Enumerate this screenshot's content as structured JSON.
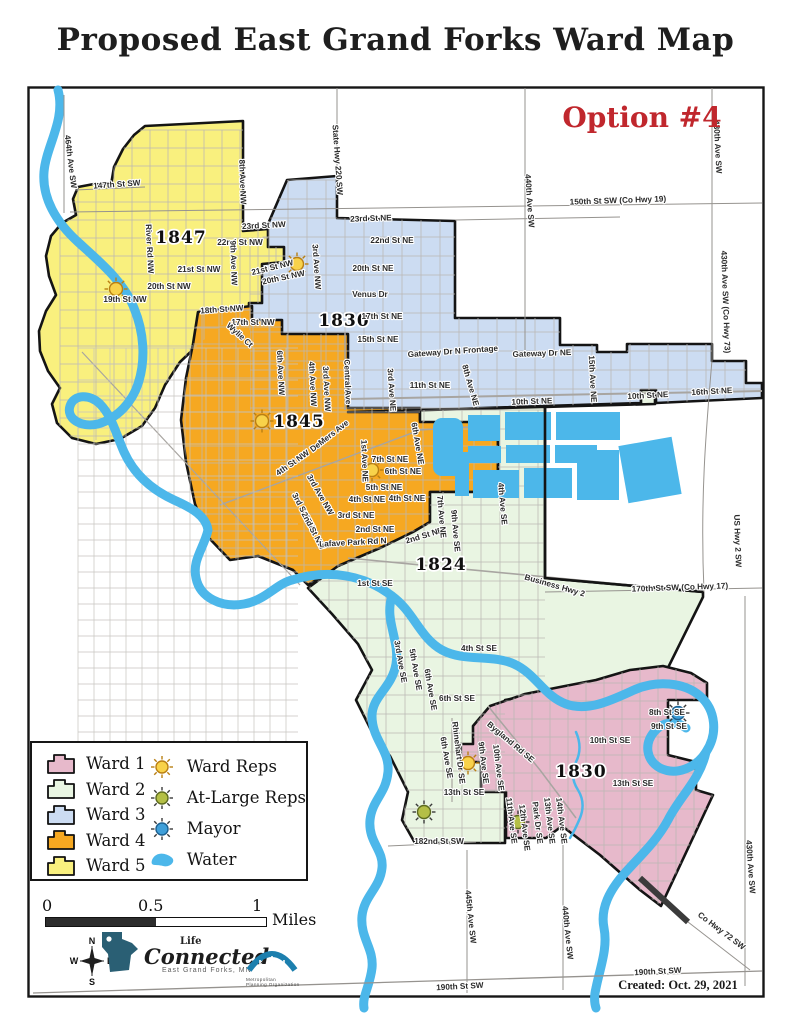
{
  "title": "Proposed East Grand Forks Ward Map",
  "option_label": "Option #4",
  "created_label": "Created: Oct. 29, 2021",
  "colors": {
    "ward1": "#e7b9cb",
    "ward2": "#e9f5e2",
    "ward3": "#ccdcf2",
    "ward4": "#f6a821",
    "ward5": "#f9f07e",
    "water": "#4cb7ea",
    "red": "#c0272d",
    "boundary": "#141414",
    "rep_ward_fill": "#f8d24a",
    "rep_ward_ray": "#b97f13",
    "rep_atlarge_fill": "#b4bf46",
    "rep_mayor_fill": "#3f9fd9",
    "rep_dark_ray": "#3a3a3a",
    "logo_teal": "#2a5f74",
    "logo_arch": "#1c7fae"
  },
  "legend": {
    "wards": [
      {
        "label": "Ward 1",
        "color_key": "ward1"
      },
      {
        "label": "Ward 2",
        "color_key": "ward2"
      },
      {
        "label": "Ward 3",
        "color_key": "ward3"
      },
      {
        "label": "Ward 4",
        "color_key": "ward4"
      },
      {
        "label": "Ward 5",
        "color_key": "ward5"
      }
    ],
    "symbols": [
      {
        "label": "Ward Reps",
        "kind": "ward"
      },
      {
        "label": "At-Large Reps",
        "kind": "atlarge"
      },
      {
        "label": "Mayor",
        "kind": "mayor"
      },
      {
        "label": "Water",
        "kind": "water"
      }
    ]
  },
  "scale_bar": {
    "start": "0",
    "mid": "0.5",
    "end": "1",
    "unit": "Miles"
  },
  "compass": {
    "n": "N",
    "e": "E",
    "s": "S",
    "w": "W"
  },
  "logos": {
    "life_connected": {
      "line1": "Life",
      "line2": "Connected",
      "line3": "East Grand Forks, MN"
    },
    "mpo": {
      "line1": "Metropolitan",
      "line2": "Planning Organization"
    }
  },
  "map": {
    "ward_numbers": [
      {
        "text": "1847",
        "x": 181,
        "y": 243
      },
      {
        "text": "1830",
        "x": 344,
        "y": 326
      },
      {
        "text": "1845",
        "x": 299,
        "y": 427
      },
      {
        "text": "1824",
        "x": 441,
        "y": 570
      },
      {
        "text": "1830",
        "x": 581,
        "y": 777
      }
    ],
    "reps": [
      {
        "kind": "ward",
        "x": 116,
        "y": 289
      },
      {
        "kind": "ward",
        "x": 297,
        "y": 264
      },
      {
        "kind": "ward",
        "x": 262,
        "y": 421
      },
      {
        "kind": "ward",
        "x": 372,
        "y": 470
      },
      {
        "kind": "ward",
        "x": 468,
        "y": 763
      },
      {
        "kind": "atlarge",
        "x": 424,
        "y": 812
      },
      {
        "kind": "atlarge",
        "x": 518,
        "y": 822
      },
      {
        "kind": "mayor",
        "x": 678,
        "y": 713
      }
    ],
    "street_labels": [
      {
        "t": "464th Ave SW",
        "x": 68,
        "y": 162,
        "r": 83
      },
      {
        "t": "147th St SW",
        "x": 117,
        "y": 187,
        "r": -4
      },
      {
        "t": "River Rd NW",
        "x": 147,
        "y": 249,
        "r": 87
      },
      {
        "t": "8th Ave NW",
        "x": 240,
        "y": 182,
        "r": 88
      },
      {
        "t": "23rd St NW",
        "x": 264,
        "y": 228,
        "r": -3
      },
      {
        "t": "22nd St NW",
        "x": 240,
        "y": 245,
        "r": 0
      },
      {
        "t": "21st St NW",
        "x": 199,
        "y": 272,
        "r": 0
      },
      {
        "t": "20th St NW",
        "x": 169,
        "y": 289,
        "r": 0
      },
      {
        "t": "19th St NW",
        "x": 125,
        "y": 302,
        "r": 0
      },
      {
        "t": "18th St NW",
        "x": 222,
        "y": 312,
        "r": -4
      },
      {
        "t": "17th St NW",
        "x": 253,
        "y": 325,
        "r": 0
      },
      {
        "t": "9th Ave NW",
        "x": 231,
        "y": 263,
        "r": 88
      },
      {
        "t": "21st St NW",
        "x": 273,
        "y": 270,
        "r": -14
      },
      {
        "t": "20th St NW",
        "x": 284,
        "y": 280,
        "r": -12
      },
      {
        "t": "State Hwy 220 SW",
        "x": 335,
        "y": 160,
        "r": 86
      },
      {
        "t": "23rd St NE",
        "x": 371,
        "y": 221,
        "r": -2
      },
      {
        "t": "22nd St NE",
        "x": 392,
        "y": 243,
        "r": 0
      },
      {
        "t": "3rd Ave NW",
        "x": 314,
        "y": 267,
        "r": 86
      },
      {
        "t": "20th St NE",
        "x": 373,
        "y": 271,
        "r": 0
      },
      {
        "t": "Venus Dr",
        "x": 370,
        "y": 297,
        "r": 0
      },
      {
        "t": "17th St NE",
        "x": 382,
        "y": 319,
        "r": 0
      },
      {
        "t": "15th St NE",
        "x": 378,
        "y": 342,
        "r": 0
      },
      {
        "t": "Gateway Dr N Frontage",
        "x": 453,
        "y": 354,
        "r": -4
      },
      {
        "t": "Gateway Dr NE",
        "x": 542,
        "y": 356,
        "r": -2
      },
      {
        "t": "3rd Ave NE",
        "x": 389,
        "y": 390,
        "r": 86
      },
      {
        "t": "11th St NE",
        "x": 430,
        "y": 388,
        "r": 0
      },
      {
        "t": "8th Ave NE",
        "x": 468,
        "y": 386,
        "r": 74
      },
      {
        "t": "15th Ave NE",
        "x": 590,
        "y": 379,
        "r": 87
      },
      {
        "t": "10th St NE",
        "x": 532,
        "y": 404,
        "r": -2
      },
      {
        "t": "10th St NE",
        "x": 648,
        "y": 398,
        "r": -3
      },
      {
        "t": "16th St NE",
        "x": 712,
        "y": 394,
        "r": -3
      },
      {
        "t": "150th St SW (Co Hwy 19)",
        "x": 618,
        "y": 203,
        "r": -2
      },
      {
        "t": "440th Ave SW",
        "x": 527,
        "y": 201,
        "r": 86
      },
      {
        "t": "430th Ave SW",
        "x": 715,
        "y": 147,
        "r": 87
      },
      {
        "t": "430th Ave SW (Co Hwy 73)",
        "x": 723,
        "y": 302,
        "r": 88
      },
      {
        "t": "Wylie Ct",
        "x": 238,
        "y": 337,
        "r": 42
      },
      {
        "t": "6th Ave NW",
        "x": 278,
        "y": 373,
        "r": 87
      },
      {
        "t": "4th Ave NW",
        "x": 310,
        "y": 384,
        "r": 87
      },
      {
        "t": "3rd Ave NW",
        "x": 324,
        "y": 389,
        "r": 87
      },
      {
        "t": "Central Ave",
        "x": 345,
        "y": 382,
        "r": 88
      },
      {
        "t": "DeMers Ave",
        "x": 331,
        "y": 438,
        "r": -38
      },
      {
        "t": "4th St NW",
        "x": 294,
        "y": 465,
        "r": -35
      },
      {
        "t": "1st Ave NE",
        "x": 362,
        "y": 461,
        "r": 88
      },
      {
        "t": "7th St NE",
        "x": 390,
        "y": 462,
        "r": 0
      },
      {
        "t": "6th St NE",
        "x": 403,
        "y": 474,
        "r": 0
      },
      {
        "t": "5th St NE",
        "x": 384,
        "y": 490,
        "r": 0
      },
      {
        "t": "4th St NE",
        "x": 367,
        "y": 502,
        "r": 0
      },
      {
        "t": "4th St NE",
        "x": 407,
        "y": 501,
        "r": 0
      },
      {
        "t": "6th Ave NE",
        "x": 415,
        "y": 444,
        "r": 80
      },
      {
        "t": "3rd Ave NW",
        "x": 318,
        "y": 496,
        "r": 60
      },
      {
        "t": "3rd St NW",
        "x": 301,
        "y": 512,
        "r": 62
      },
      {
        "t": "2nd St NW",
        "x": 311,
        "y": 532,
        "r": 62
      },
      {
        "t": "3rd St NE",
        "x": 356,
        "y": 518,
        "r": 0
      },
      {
        "t": "2nd St NE",
        "x": 375,
        "y": 532,
        "r": 0
      },
      {
        "t": "2nd St NE",
        "x": 425,
        "y": 538,
        "r": -17
      },
      {
        "t": "Lafave Park Rd N",
        "x": 353,
        "y": 545,
        "r": -3
      },
      {
        "t": "7th Ave NE",
        "x": 439,
        "y": 517,
        "r": 85
      },
      {
        "t": "9th Ave SE",
        "x": 453,
        "y": 531,
        "r": 85
      },
      {
        "t": "4th Ave SE",
        "x": 500,
        "y": 504,
        "r": 85
      },
      {
        "t": "1st St SE",
        "x": 375,
        "y": 586,
        "r": 0
      },
      {
        "t": "Business Hwy 2",
        "x": 554,
        "y": 588,
        "r": 16
      },
      {
        "t": "170th St SW (Co Hwy 17)",
        "x": 680,
        "y": 590,
        "r": -2
      },
      {
        "t": "US Hwy 2 SW",
        "x": 735,
        "y": 541,
        "r": 88
      },
      {
        "t": "3rd Ave SE",
        "x": 398,
        "y": 662,
        "r": 80
      },
      {
        "t": "5th Ave SE",
        "x": 413,
        "y": 670,
        "r": 80
      },
      {
        "t": "6th Ave SE",
        "x": 428,
        "y": 690,
        "r": 80
      },
      {
        "t": "4th St SE",
        "x": 479,
        "y": 651,
        "r": 0
      },
      {
        "t": "6th St SE",
        "x": 457,
        "y": 701,
        "r": 0
      },
      {
        "t": "Rhinehart Dr SE",
        "x": 456,
        "y": 753,
        "r": 83
      },
      {
        "t": "6th Ave SE",
        "x": 444,
        "y": 758,
        "r": 80
      },
      {
        "t": "13th St SE",
        "x": 464,
        "y": 795,
        "r": 0
      },
      {
        "t": "182nd St SW",
        "x": 439,
        "y": 844,
        "r": 0
      },
      {
        "t": "Bygland Rd SE",
        "x": 509,
        "y": 744,
        "r": 40
      },
      {
        "t": "9th Ave SE",
        "x": 481,
        "y": 763,
        "r": 83
      },
      {
        "t": "10th Ave SE",
        "x": 496,
        "y": 768,
        "r": 83
      },
      {
        "t": "8th St SE",
        "x": 667,
        "y": 715,
        "r": 0
      },
      {
        "t": "9th St SE",
        "x": 669,
        "y": 729,
        "r": 0
      },
      {
        "t": "10th St SE",
        "x": 610,
        "y": 743,
        "r": 0
      },
      {
        "t": "13th St SE",
        "x": 633,
        "y": 786,
        "r": 0
      },
      {
        "t": "11th Ave SE",
        "x": 509,
        "y": 821,
        "r": 83
      },
      {
        "t": "12th Ave SE",
        "x": 522,
        "y": 828,
        "r": 83
      },
      {
        "t": "Park Dr SE",
        "x": 535,
        "y": 823,
        "r": 83
      },
      {
        "t": "13th Ave SE",
        "x": 547,
        "y": 821,
        "r": 83
      },
      {
        "t": "14th Ave SE",
        "x": 559,
        "y": 821,
        "r": 83
      },
      {
        "t": "445th Ave SW",
        "x": 468,
        "y": 917,
        "r": 84
      },
      {
        "t": "440th Ave SW",
        "x": 565,
        "y": 933,
        "r": 84
      },
      {
        "t": "430th Ave SW",
        "x": 748,
        "y": 867,
        "r": 86
      },
      {
        "t": "Co Hwy 72 SW",
        "x": 720,
        "y": 933,
        "r": 37
      },
      {
        "t": "190th St SW",
        "x": 460,
        "y": 989,
        "r": -3
      },
      {
        "t": "190th St SW",
        "x": 658,
        "y": 974,
        "r": -3
      }
    ]
  }
}
